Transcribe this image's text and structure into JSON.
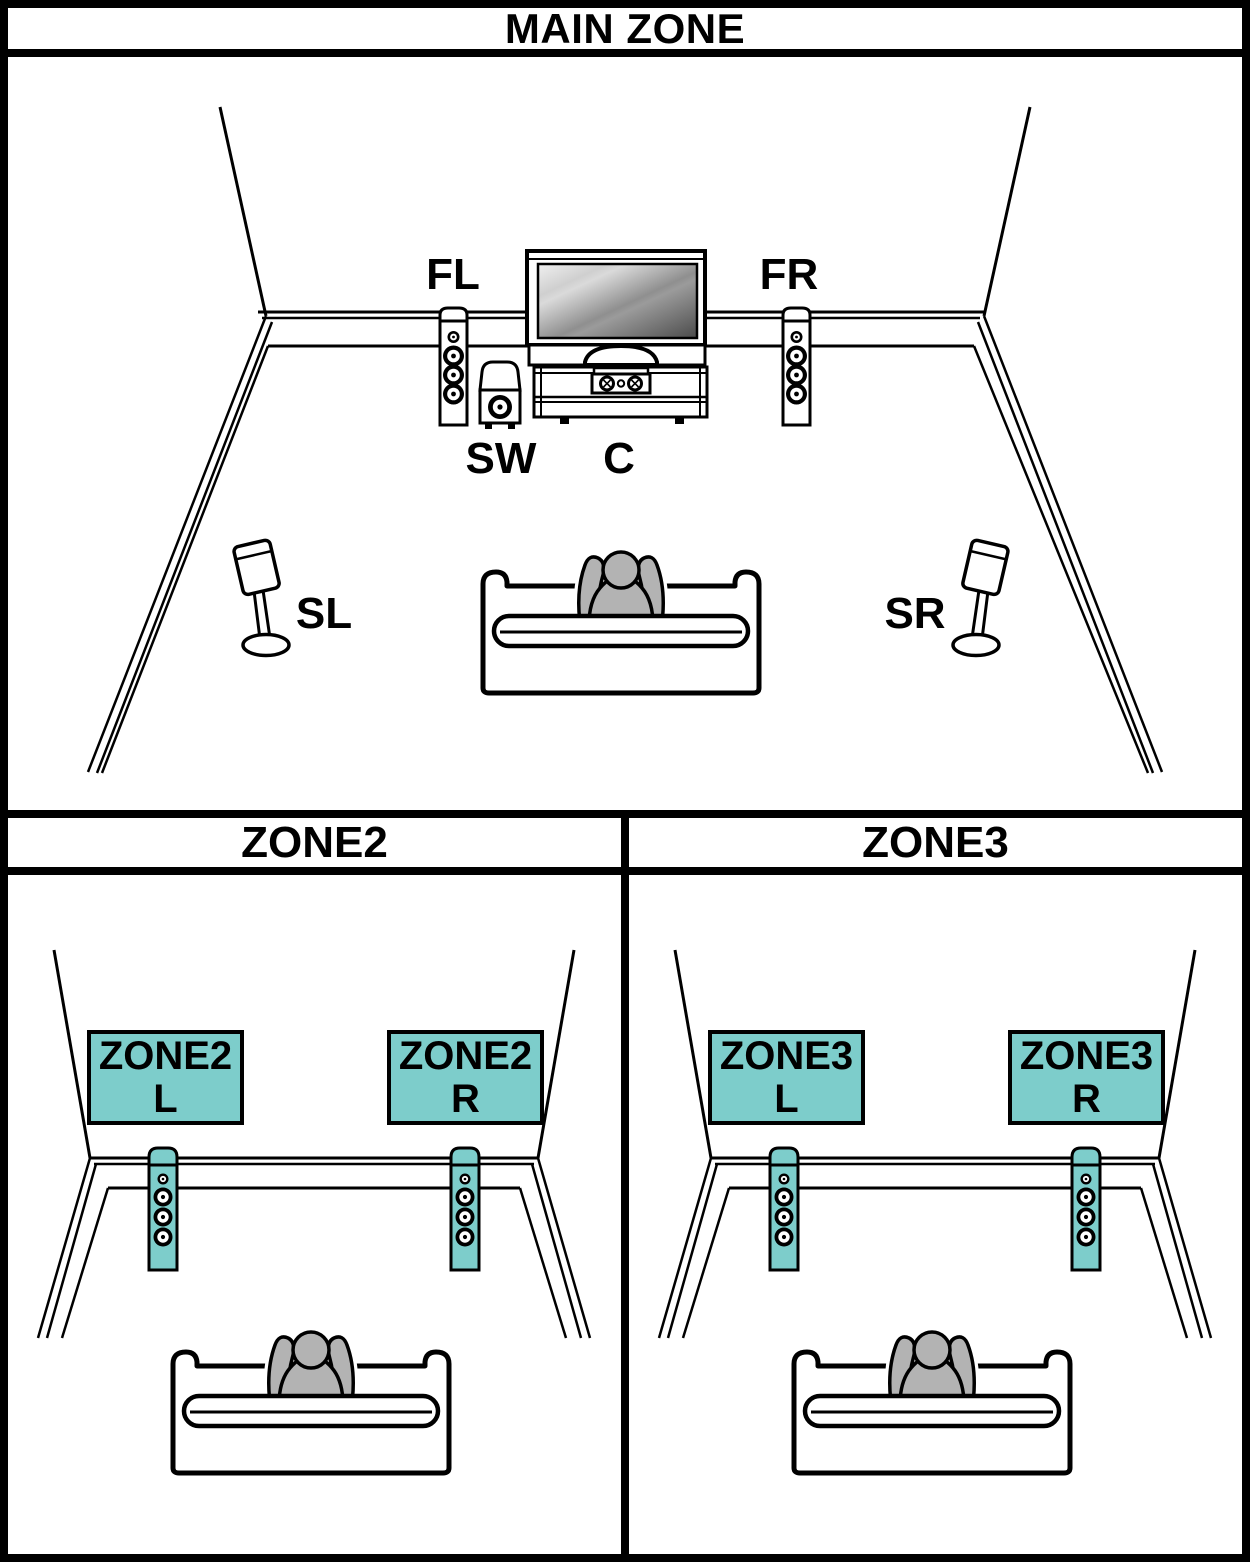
{
  "header": {
    "main_zone_title": "MAIN ZONE"
  },
  "main_zone": {
    "speaker_labels": {
      "front_left": "FL",
      "front_right": "FR",
      "subwoofer": "SW",
      "center": "C",
      "surround_left": "SL",
      "surround_right": "SR"
    }
  },
  "zones": [
    {
      "title": "ZONE2",
      "left_speaker_tag": {
        "line1": "ZONE2",
        "line2": "L"
      },
      "right_speaker_tag": {
        "line1": "ZONE2",
        "line2": "R"
      }
    },
    {
      "title": "ZONE3",
      "left_speaker_tag": {
        "line1": "ZONE3",
        "line2": "L"
      },
      "right_speaker_tag": {
        "line1": "ZONE3",
        "line2": "R"
      }
    }
  ],
  "colors": {
    "highlight_teal": "#7DCDCB",
    "person_gray": "#B3B3B3",
    "outline_black": "#000000"
  }
}
